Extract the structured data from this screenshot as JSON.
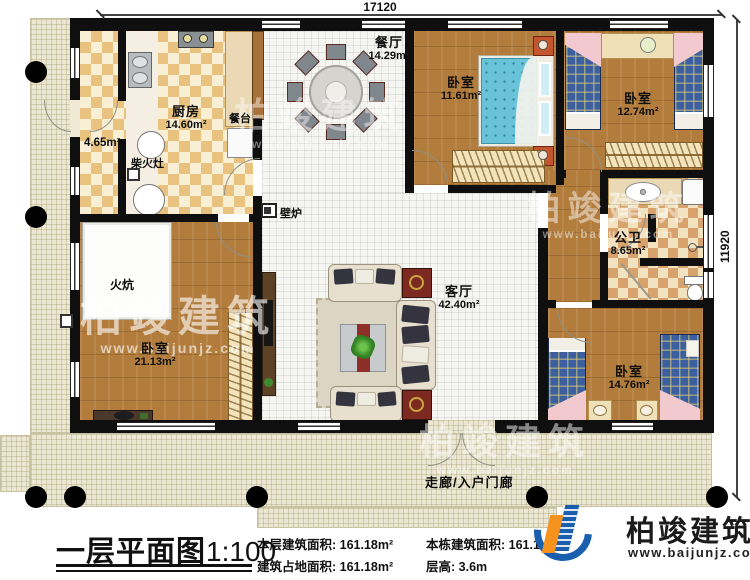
{
  "plan": {
    "dim_top": "17120",
    "dim_right": "11920",
    "rooms": {
      "dining": {
        "name": "餐厅",
        "area": "14.29m²"
      },
      "bedroom_top_mid": {
        "name": "卧室",
        "area": "11.61m²"
      },
      "bedroom_top_right": {
        "name": "卧室",
        "area": "12.74m²"
      },
      "kitchen": {
        "name": "厨房",
        "area": "14.60m²"
      },
      "counter": {
        "name": "餐台"
      },
      "storage_area": {
        "area": "4.65m²"
      },
      "wood_stove": {
        "name": "柴火灶"
      },
      "fireplace": {
        "name": "壁炉"
      },
      "bathroom": {
        "name": "公卫",
        "area": "8.65m²"
      },
      "kang": {
        "name": "火炕"
      },
      "bedroom_left": {
        "name": "卧室",
        "area": "21.13m²"
      },
      "living": {
        "name": "客厅",
        "area": "42.40m²"
      },
      "bedroom_bottom_right": {
        "name": "卧室",
        "area": "14.76m²"
      },
      "porch": {
        "name": "走廊/入户门廊"
      }
    }
  },
  "title_block": {
    "title": "一层平面图",
    "scale": "1:100",
    "stats": [
      {
        "label": "本层建筑面积:",
        "value": "161.18m²"
      },
      {
        "label": "本栋建筑面积:",
        "value": "161.1"
      },
      {
        "label": "建筑占地面积:",
        "value": "161.18m²"
      },
      {
        "label": "层高:",
        "value": "3.6m"
      }
    ]
  },
  "brand": {
    "name": "柏竣建筑",
    "url": "www.baijunjz.com",
    "blue": "#1a5fae",
    "orange": "#f6921e"
  },
  "watermark": {
    "text": "柏竣建筑",
    "url": "www.baijunjz.com"
  }
}
